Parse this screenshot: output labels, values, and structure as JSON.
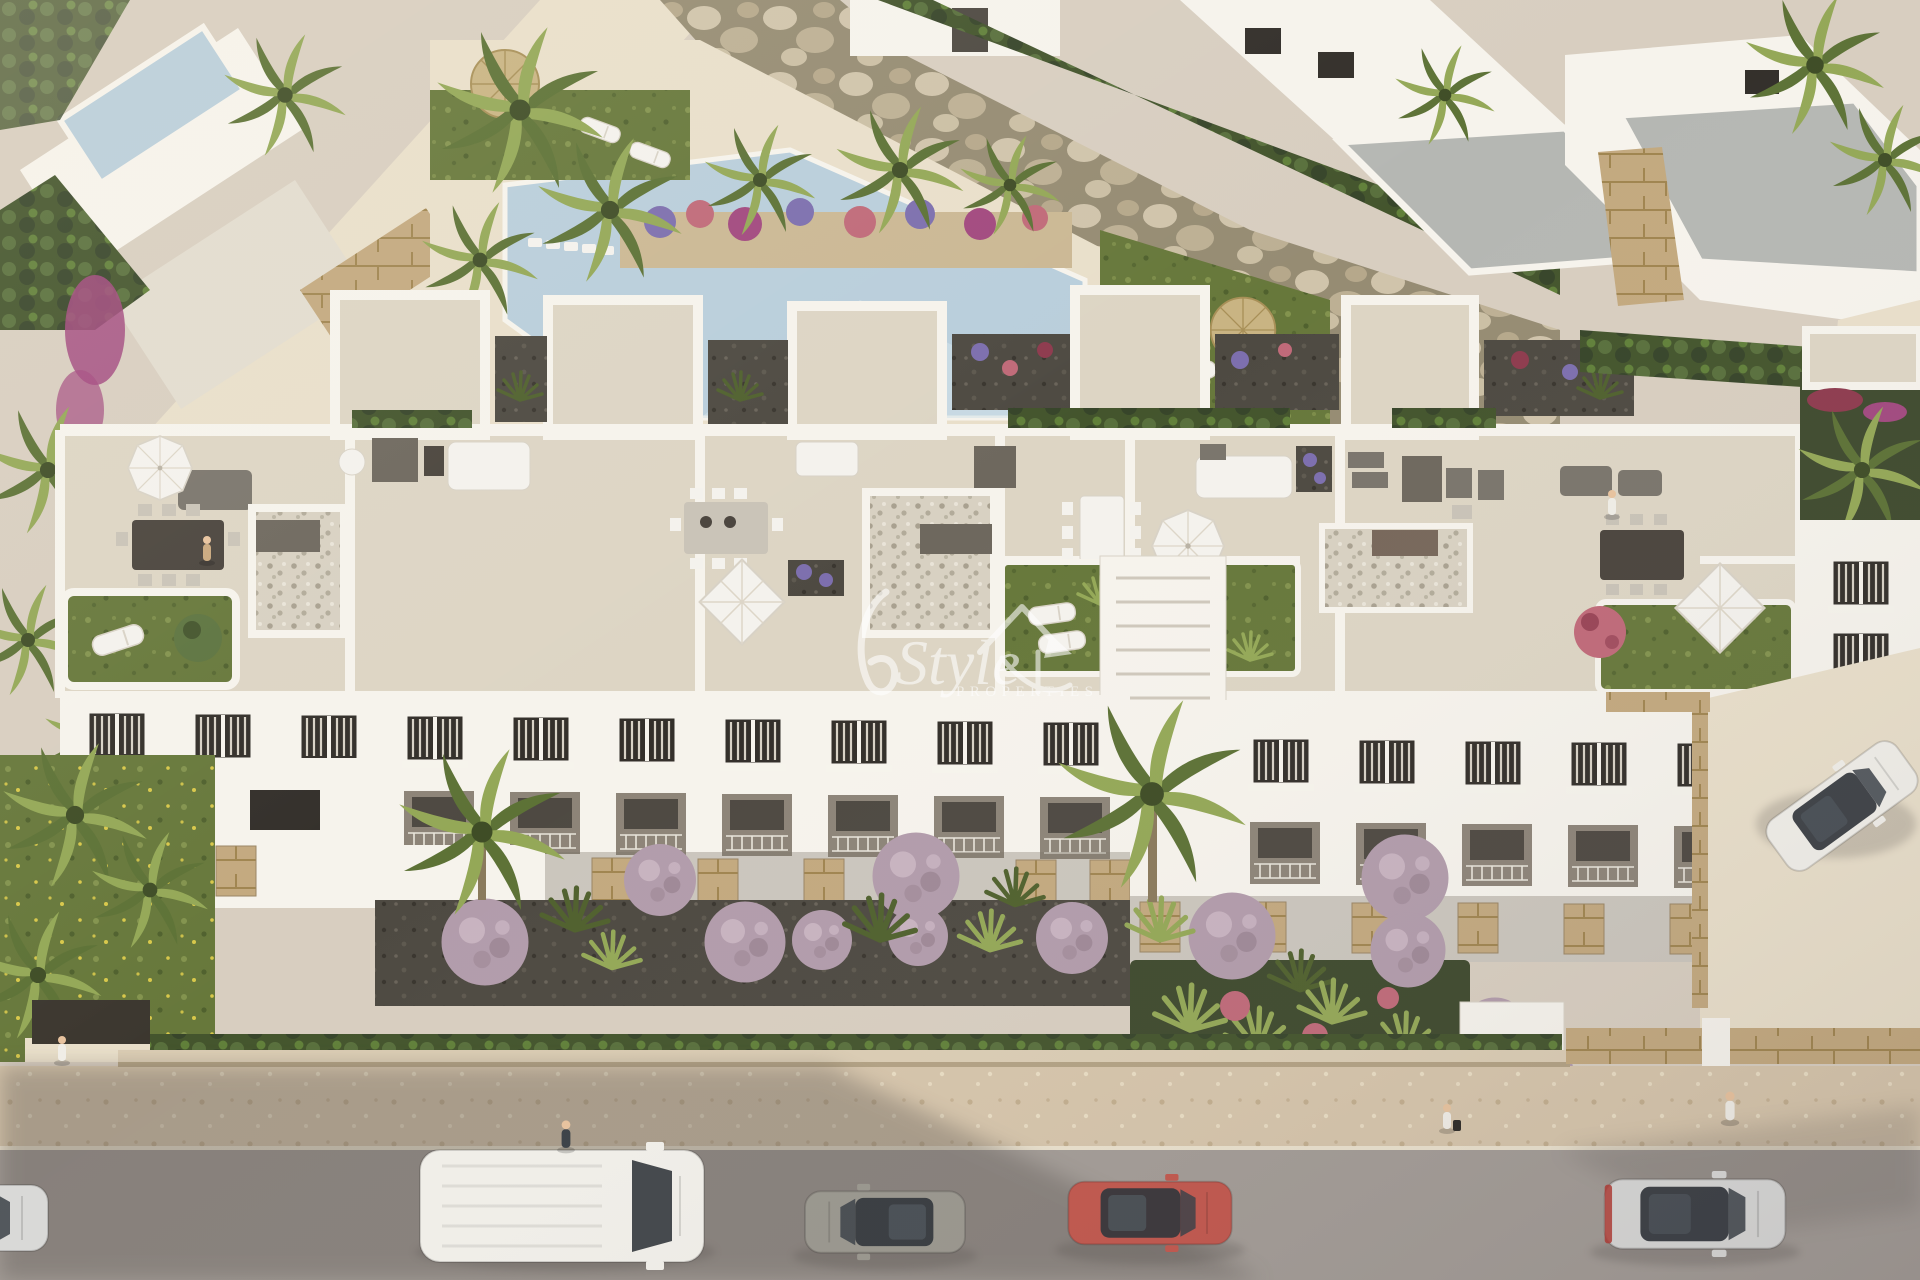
{
  "image": {
    "type": "aerial-3d-architectural-render",
    "subject": "White Mediterranean apartment complex with rooftop solarium terraces, community pool with rock wall, front gardens with round mauve shrubs and palms, street with vehicles and pedestrians"
  },
  "watermark": {
    "brand_script": "Style",
    "brand_sub": "PROPERTIES",
    "icon": "house-arrow-icon",
    "color": "#ffffff",
    "opacity": 0.58
  },
  "vehicles": [
    {
      "name": "white-van",
      "color_key": "car_white"
    },
    {
      "name": "grey-hatchback",
      "color_key": "car_grey"
    },
    {
      "name": "red-hatchback",
      "color_key": "car_red"
    },
    {
      "name": "silver-sedan",
      "color_key": "car_silver"
    },
    {
      "name": "parked-white-car",
      "color_key": "car_white"
    },
    {
      "name": "partial-silver-car",
      "color_key": "car_silver"
    }
  ],
  "colors": {
    "paving": "#d8cec0",
    "paving_sun": "#e9dfca",
    "sidewalk": "#d6c5ab",
    "sidewalk_dot": "#c2ae8e",
    "sidewalk_light": "#e9ddc3",
    "curb": "#efe7d6",
    "road": "#a39c96",
    "shadow": "#524d48",
    "wall_white": "#f6f3ec",
    "wall_shade": "#e2dccf",
    "terrace_floor": "#ddd5c4",
    "roof_grey": "#b5b7b3",
    "stone_tan": "#c3a97f",
    "stone_line": "#a08550",
    "lawn": "#67783b",
    "lawn_light": "#8a9a52",
    "lawn_dark": "#50612e",
    "flower_yellow": "#d8c84a",
    "hedge": "#44552d",
    "hedge_light": "#5d7440",
    "palm_green": "#5d7236",
    "palm_light": "#94a857",
    "palm_core": "#3f4d26",
    "trunk": "#8a7a5c",
    "rock_base": "#968c73",
    "rock_light": "#d0c4ab",
    "rock_mid": "#bdb094",
    "pebble_base": "#d8d1c2",
    "pebble_dot": "#a9a190",
    "gravel_dark": "#4e4a42",
    "bed_dark": "#3f4a2e",
    "bush_mauve": "#b29cab",
    "bush_light": "#cdb9c6",
    "bush_dark": "#97818f",
    "flower_pink": "#c06a79",
    "flower_red": "#8e3b4e",
    "flower_purple": "#7d6fae",
    "bougainvillea": "#a2497f",
    "pool": "#b9cedb",
    "pool_light": "#d3e1e9",
    "furn_grey": "#7a756c",
    "furn_dark": "#4a443d",
    "furn_light": "#c9c3b7",
    "shed_grey": "#6e685e",
    "shed_brown": "#77675a",
    "furn_white": "#f4f2ed",
    "glass": "#2f3338",
    "window_dark": "#332f2a",
    "window_slat": "#d8d2c6",
    "recess": "#8d8478",
    "door_dark": "#4e4942",
    "car_white": "#f1efe9",
    "car_grey": "#9a978e",
    "car_red": "#c2574d",
    "car_silver": "#d9d9d7",
    "tail_red": "#b23a33",
    "skin": "#e8c39e",
    "person_navy": "#3a4046",
    "person_white": "#f0ede6",
    "person_tan": "#c9a87e"
  }
}
